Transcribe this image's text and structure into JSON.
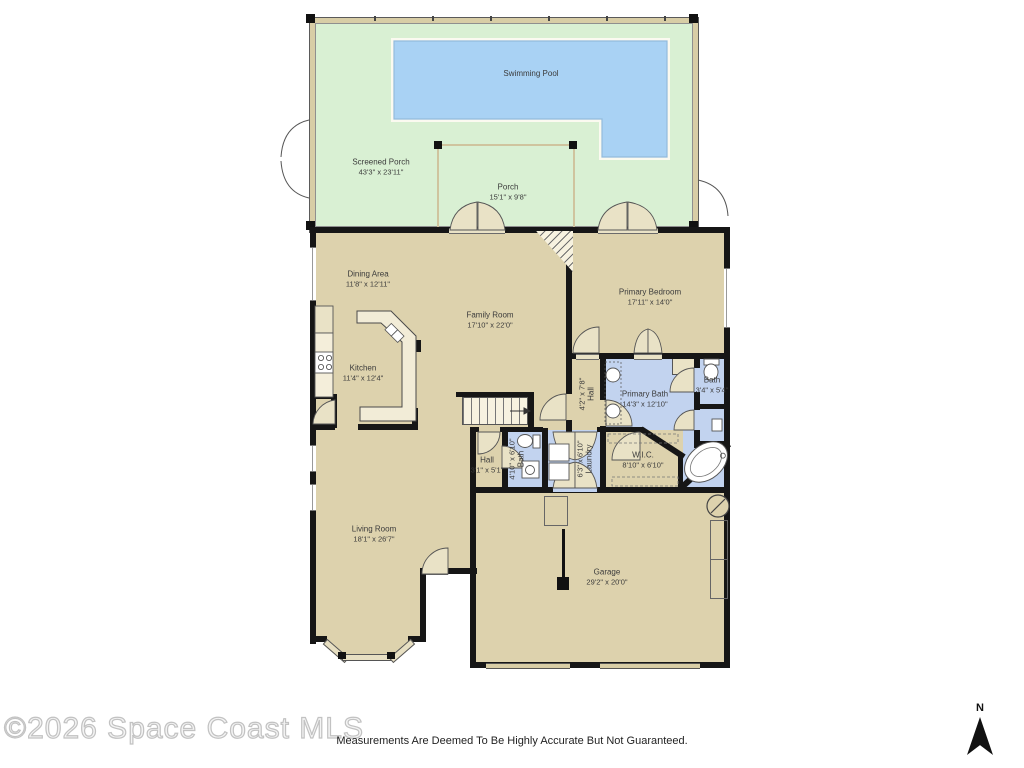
{
  "title": "Residential Floor Plan",
  "rooms": {
    "swimming_pool": {
      "name": "Swimming Pool",
      "dims": ""
    },
    "screened_porch": {
      "name": "Screened Porch",
      "dims": "43'3\" x 23'11\""
    },
    "porch": {
      "name": "Porch",
      "dims": "15'1\" x 9'8\""
    },
    "dining": {
      "name": "Dining Area",
      "dims": "11'8\" x 12'11\""
    },
    "family": {
      "name": "Family Room",
      "dims": "17'10\" x 22'0\""
    },
    "primary_bedroom": {
      "name": "Primary Bedroom",
      "dims": "17'11\" x 14'0\""
    },
    "kitchen": {
      "name": "Kitchen",
      "dims": "11'4\" x 12'4\""
    },
    "hall_upper": {
      "name": "Hall",
      "dims": "4'2\" x 7'8\""
    },
    "primary_bath": {
      "name": "Primary Bath",
      "dims": "14'3\" x 12'10\""
    },
    "bath_small": {
      "name": "Bath",
      "dims": "3'4\" x 5'4\""
    },
    "hall_lower": {
      "name": "Hall",
      "dims": "3'1\" x 5'1\""
    },
    "bath_hall": {
      "name": "Bath",
      "dims": "4'10\" x 6'10\""
    },
    "laundry": {
      "name": "Laundry",
      "dims": "6'3\" x 6'10\""
    },
    "wic": {
      "name": "W.I.C.",
      "dims": "8'10\" x 6'10\""
    },
    "living": {
      "name": "Living Room",
      "dims": "18'1\" x 26'7\""
    },
    "garage": {
      "name": "Garage",
      "dims": "29'2\" x 20'0\""
    }
  },
  "footer": {
    "copyright": "©2026 Space Coast MLS",
    "disclaimer": "Measurements Are Deemed To Be Highly Accurate But Not Guaranteed.",
    "compass_label": "N"
  },
  "colors": {
    "floor_tan": "#ddd2ad",
    "room_blue": "#c2d3ef",
    "porch_green": "#d9f0d3",
    "pool_blue": "#a9d2f4",
    "wall_black": "#161616",
    "watermark_gray": "#c9c9c9"
  }
}
